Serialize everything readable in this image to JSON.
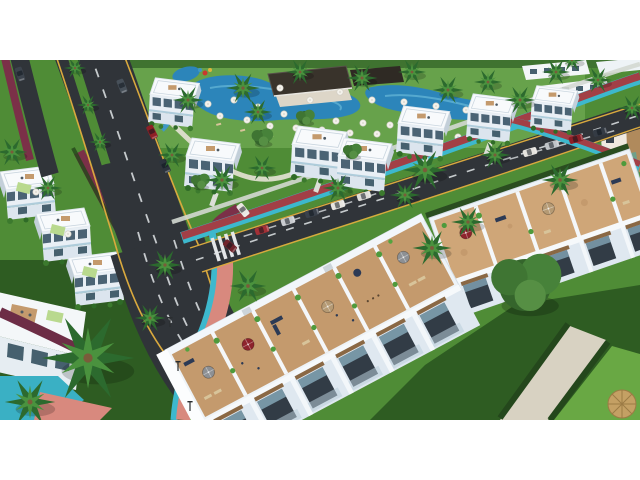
{
  "scene": {
    "description": "Aerial 3D architectural rendering of a resort residential development: white modern villas and two townhouse rows with furnished rooftop terraces, a large swimming-pool and clubhouse complex with white parasols, palm-lined asphalt boulevard and avenue with red cycle lanes, teal curbs, salmon promenade, parked and moving cars, lawns, hedges and a giant foreground palm. Render is letterboxed with white bars top and bottom.",
    "format": "640x360 render centered on white 640x480 canvas"
  },
  "palette": {
    "letterbox": "#ffffff",
    "grass": "#4f8c36",
    "grass_light": "#67a24b",
    "grass_dark": "#2e5c22",
    "lawn_bright": "#69a844",
    "hedge": "#24471c",
    "asphalt": "#303439",
    "road_line_yellow": "#d9a93e",
    "road_dash_white": "#d6dadd",
    "bike_path_red": "#a23f46",
    "bike_path_maroon": "#7b3048",
    "curb_teal": "#3db8cd",
    "pool_teal": "#3ab0c4",
    "path_salmon": "#d8897e",
    "sidewalk": "#d3d8d2",
    "pool_blue": "#2c85ba",
    "pool_light": "#60b1d4",
    "deck_wood": "#c49a6d",
    "deck_wood_light": "#cfa678",
    "building_white": "#f2f6f9",
    "building_shadow": "#c7d2dc",
    "window_glass": "#8fb4c6",
    "window_dark": "#37424d",
    "wood_accent": "#8a6844",
    "roof_dark": "#39332b",
    "umbrella_red": "#8e232c",
    "umbrella_tan": "#b59a74",
    "umbrella_gray": "#8d9094",
    "parasol_white": "#f4f2ec",
    "palm_dark": "#2c6a2e",
    "palm_light": "#4a923e",
    "gravel": "#d8d2c2",
    "thatch": "#c4a064",
    "awning_green": "#b9d98e",
    "furniture_navy": "#2c3a55"
  },
  "resort": {
    "pool_count": 3,
    "parasol_count": 30,
    "clubhouse": "dark flat-roof pool-bar pavilion",
    "water_slide_colors": [
      "#c8392f",
      "#e0b43a",
      "#3f98c4"
    ]
  },
  "buildings": {
    "mid_villa_count": 7,
    "left_villa_count": 4,
    "townhouse_rows": 2,
    "row1_terrace_units": 6,
    "row2_terrace_units": 5,
    "apartment_slabs_top_right": 3,
    "corner_building_bottom_left": 1
  },
  "roads": {
    "boulevard": {
      "surface": "asphalt",
      "edge_line": "yellow",
      "lane_dashes": "white",
      "median": "green with palms"
    },
    "avenue": {
      "surface": "asphalt",
      "parking": "parallel bays, two clusters"
    },
    "cycle_path": {
      "color": "red with teal curb"
    },
    "promenade": {
      "color": "salmon with teal edge"
    }
  },
  "vehicles": [
    {
      "type": "car",
      "color": "#8f2026",
      "location": "boulevard upper"
    },
    {
      "type": "car",
      "color": "#2c333d",
      "location": "boulevard middle"
    },
    {
      "type": "car",
      "color": "#475059",
      "location": "boulevard top"
    },
    {
      "type": "van",
      "color": "#e9e7e2",
      "location": "boulevard lower"
    },
    {
      "type": "car",
      "color": "#70242b",
      "location": "boulevard at curve"
    },
    {
      "type": "car",
      "color": "#a33036",
      "location": "avenue parking west"
    },
    {
      "type": "car",
      "color": "#c9ccd0",
      "location": "avenue parking west"
    },
    {
      "type": "car",
      "color": "#3a414b",
      "location": "avenue parking west"
    },
    {
      "type": "van",
      "color": "#e8e6e1",
      "location": "avenue parking west"
    },
    {
      "type": "car",
      "color": "#dfdeda",
      "location": "avenue parking west"
    },
    {
      "type": "car",
      "color": "#e6e4df",
      "location": "avenue parking east"
    },
    {
      "type": "car",
      "color": "#bfc3c7",
      "location": "avenue parking east"
    },
    {
      "type": "car",
      "color": "#8c1f26",
      "location": "avenue parking east"
    },
    {
      "type": "car",
      "color": "#343b44",
      "location": "avenue parking east"
    },
    {
      "type": "car",
      "color": "#3c434c",
      "location": "service road top-left"
    }
  ],
  "vegetation": {
    "palm_count": 28,
    "tree_count": 5,
    "hedges": true,
    "giant_foreground_palm": true
  },
  "terrace_umbrellas": [
    {
      "color_name": "red",
      "count": 2
    },
    {
      "color_name": "tan",
      "count": 2
    },
    {
      "color_name": "gray",
      "count": 3
    }
  ]
}
